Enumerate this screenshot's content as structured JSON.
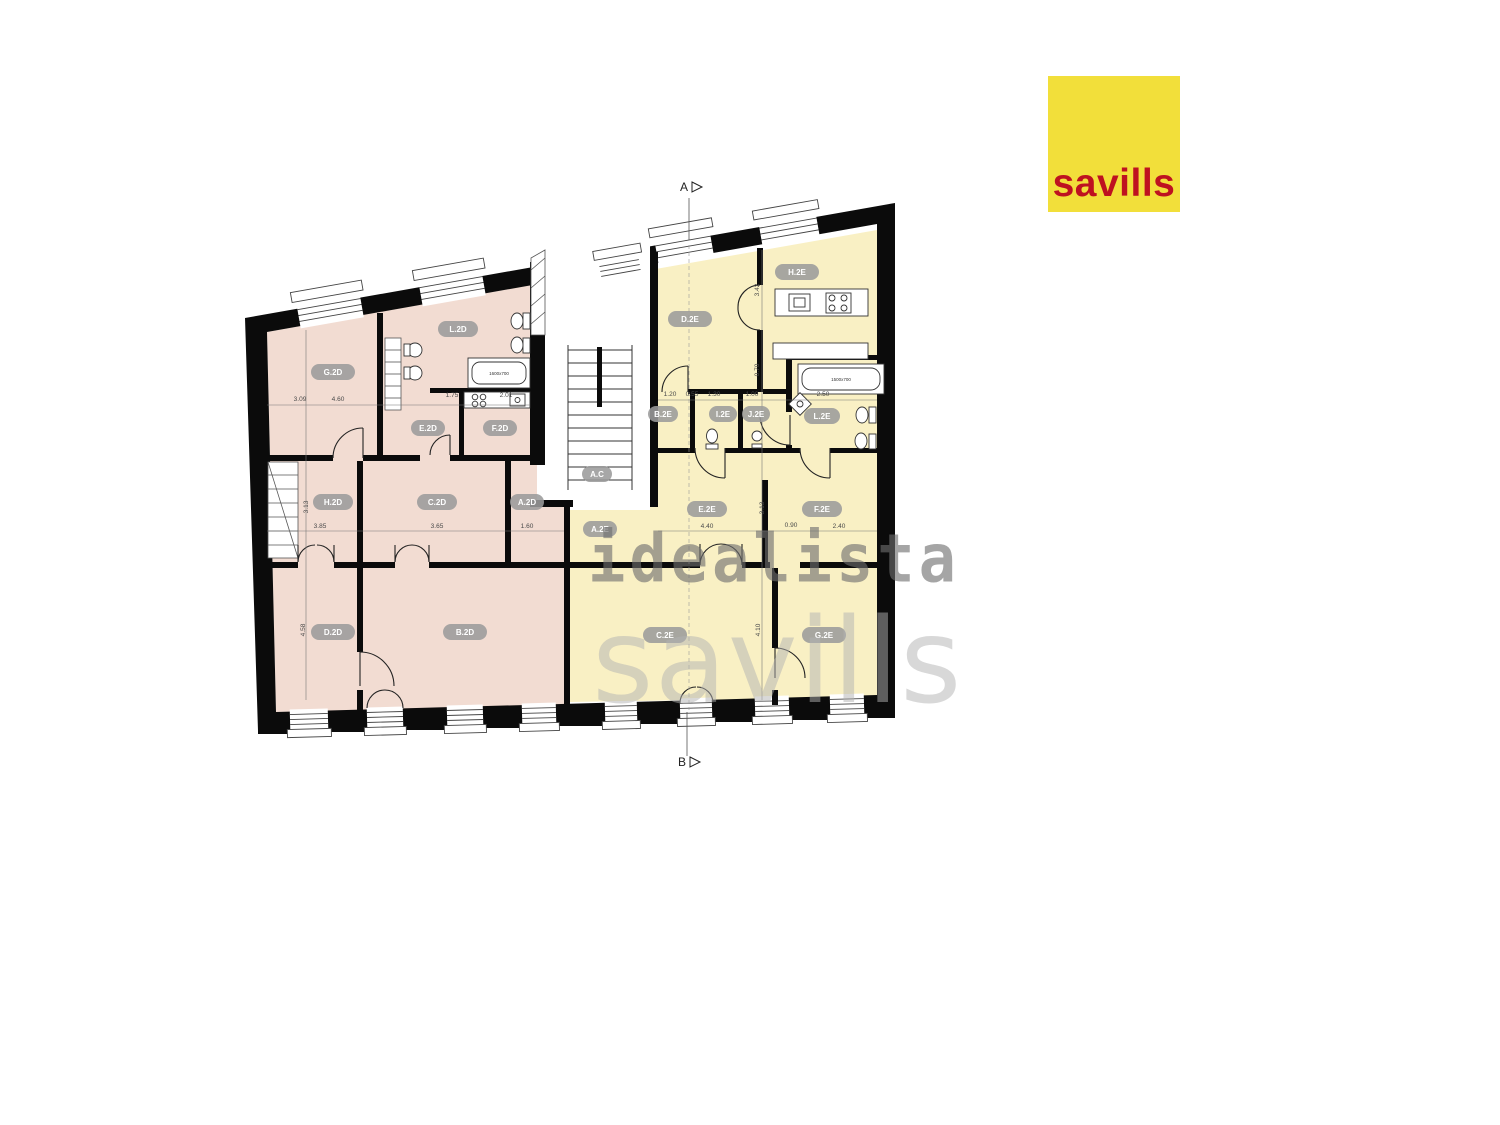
{
  "logo": {
    "text": "savills",
    "bg": "#F2DF3A",
    "fg": "#BE1220"
  },
  "watermarks": {
    "primary": "idealista",
    "secondary": "savills"
  },
  "markers": {
    "top": {
      "label": "A",
      "x": 684,
      "y": 191
    },
    "bottom": {
      "label": "B",
      "x": 682,
      "y": 766
    }
  },
  "plan": {
    "colors": {
      "left_unit_fill": "#F2DCD2",
      "right_unit_fill": "#F9F0C4",
      "wall": "#0b0b0b",
      "label_bg": "#9b9b9b",
      "label_text": "#ffffff",
      "dim_text": "#4a4a4a"
    },
    "room_labels": [
      {
        "label": "G.2D",
        "x": 333,
        "y": 372,
        "w": 44
      },
      {
        "label": "L.2D",
        "x": 458,
        "y": 329,
        "w": 40
      },
      {
        "label": "E.2D",
        "x": 428,
        "y": 428,
        "w": 34
      },
      {
        "label": "F.2D",
        "x": 500,
        "y": 428,
        "w": 34
      },
      {
        "label": "H.2D",
        "x": 333,
        "y": 502,
        "w": 40
      },
      {
        "label": "C.2D",
        "x": 437,
        "y": 502,
        "w": 40
      },
      {
        "label": "A.2D",
        "x": 527,
        "y": 502,
        "w": 34
      },
      {
        "label": "D.2D",
        "x": 333,
        "y": 632,
        "w": 44
      },
      {
        "label": "B.2D",
        "x": 465,
        "y": 632,
        "w": 44
      },
      {
        "label": "D.2E",
        "x": 690,
        "y": 319,
        "w": 44
      },
      {
        "label": "H.2E",
        "x": 797,
        "y": 272,
        "w": 44
      },
      {
        "label": "B.2E",
        "x": 663,
        "y": 414,
        "w": 30
      },
      {
        "label": "I.2E",
        "x": 723,
        "y": 414,
        "w": 28
      },
      {
        "label": "J.2E",
        "x": 756,
        "y": 414,
        "w": 28
      },
      {
        "label": "L.2E",
        "x": 822,
        "y": 416,
        "w": 36
      },
      {
        "label": "A.2E",
        "x": 600,
        "y": 529,
        "w": 34
      },
      {
        "label": "E.2E",
        "x": 707,
        "y": 509,
        "w": 40
      },
      {
        "label": "F.2E",
        "x": 822,
        "y": 509,
        "w": 40
      },
      {
        "label": "C.2E",
        "x": 665,
        "y": 635,
        "w": 44
      },
      {
        "label": "G.2E",
        "x": 824,
        "y": 635,
        "w": 44
      },
      {
        "label": "A.C",
        "x": 597,
        "y": 474,
        "w": 30
      }
    ],
    "dimensions": [
      {
        "text": "3.09",
        "x": 300,
        "y": 401
      },
      {
        "text": "4.60",
        "x": 338,
        "y": 401
      },
      {
        "text": "1.75",
        "x": 452,
        "y": 397
      },
      {
        "text": "2.01",
        "x": 506,
        "y": 397
      },
      {
        "text": "3.13",
        "x": 308,
        "y": 507,
        "rot": -90
      },
      {
        "text": "3.85",
        "x": 320,
        "y": 528
      },
      {
        "text": "3.65",
        "x": 437,
        "y": 528
      },
      {
        "text": "1.60",
        "x": 527,
        "y": 528
      },
      {
        "text": "4.58",
        "x": 305,
        "y": 630,
        "rot": -90
      },
      {
        "text": "3.42",
        "x": 759,
        "y": 290,
        "rot": -90
      },
      {
        "text": "0.70",
        "x": 759,
        "y": 370,
        "rot": -90
      },
      {
        "text": "1.20",
        "x": 670,
        "y": 396
      },
      {
        "text": "0.55",
        "x": 692,
        "y": 396
      },
      {
        "text": "1.30",
        "x": 714,
        "y": 396
      },
      {
        "text": "1.00",
        "x": 752,
        "y": 396
      },
      {
        "text": "2.50",
        "x": 823,
        "y": 396
      },
      {
        "text": "4.40",
        "x": 707,
        "y": 528
      },
      {
        "text": "0.90",
        "x": 791,
        "y": 527
      },
      {
        "text": "2.40",
        "x": 839,
        "y": 528
      },
      {
        "text": "3.13",
        "x": 764,
        "y": 508,
        "rot": -90
      },
      {
        "text": "4.10",
        "x": 760,
        "y": 630,
        "rot": -90
      }
    ],
    "fixture_labels": [
      {
        "text": "1600x700",
        "x": 499,
        "y": 375
      },
      {
        "text": "1500x700",
        "x": 841,
        "y": 381
      }
    ]
  }
}
